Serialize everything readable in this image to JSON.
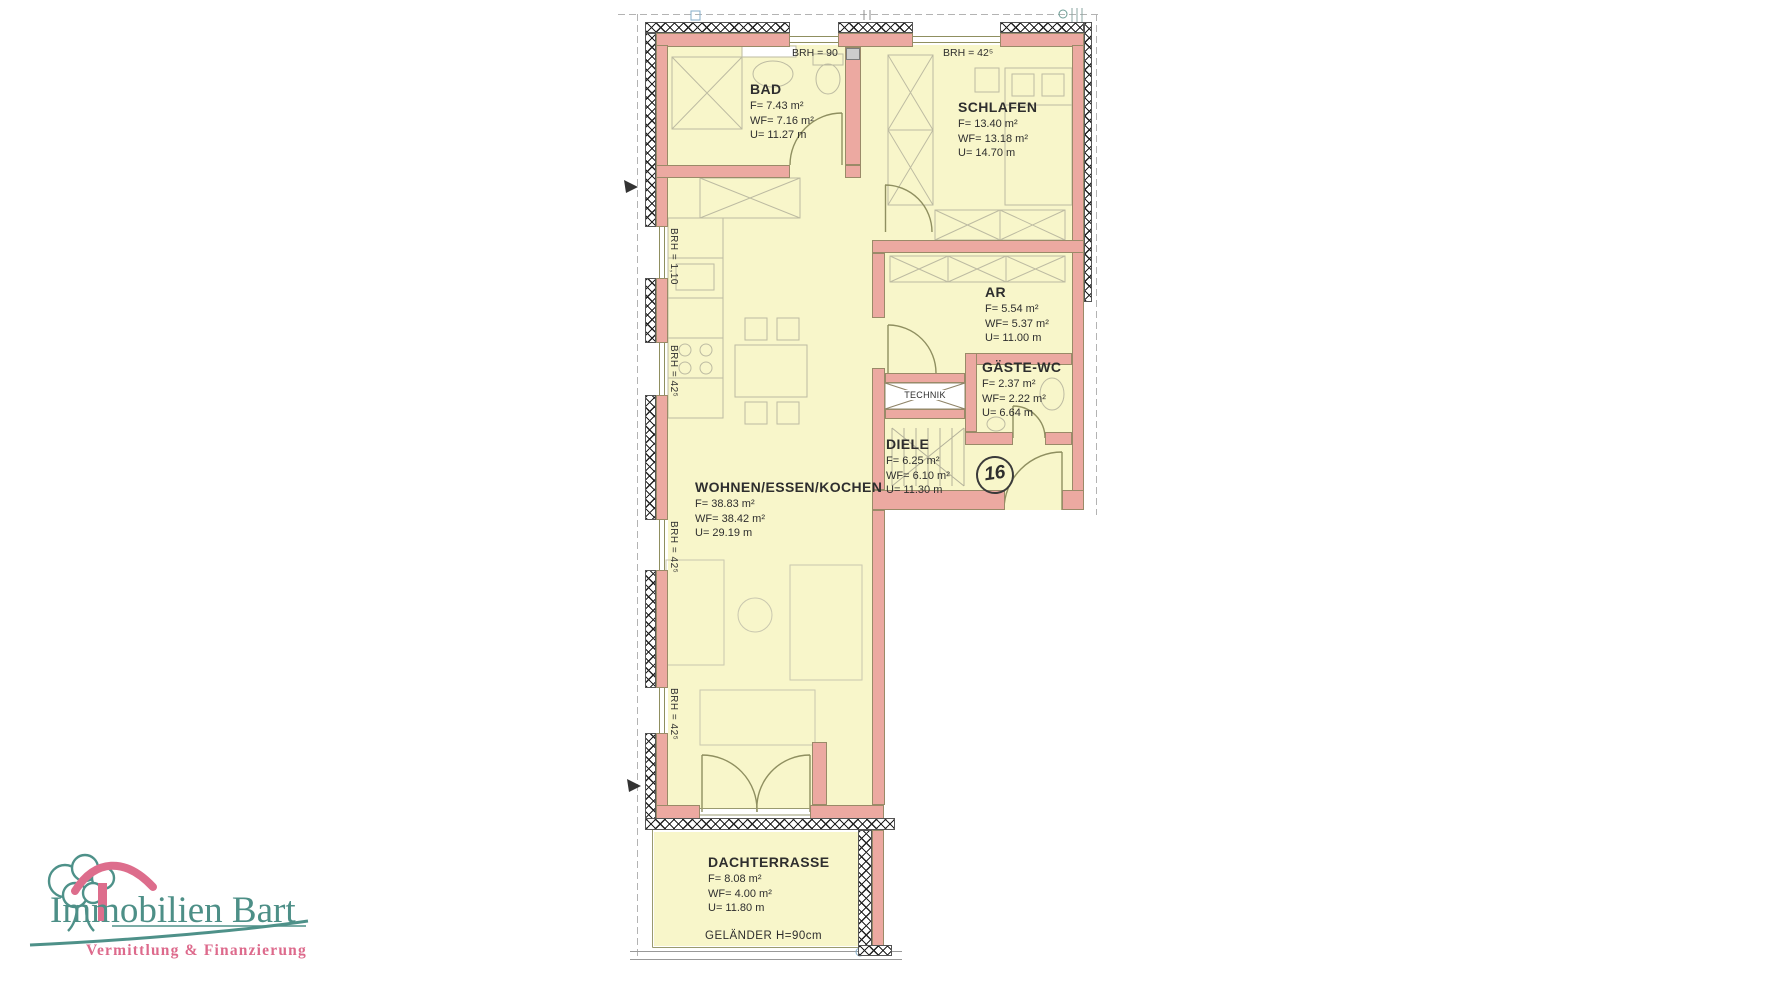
{
  "plan": {
    "rooms": {
      "bad": {
        "name": "BAD",
        "f": "F= 7.43 m²",
        "wf": "WF= 7.16 m²",
        "u": "U= 11.27 m"
      },
      "schlafen": {
        "name": "SCHLAFEN",
        "f": "F= 13.40 m²",
        "wf": "WF= 13.18 m²",
        "u": "U= 14.70 m"
      },
      "ar": {
        "name": "AR",
        "f": "F= 5.54 m²",
        "wf": "WF= 5.37 m²",
        "u": "U= 11.00 m"
      },
      "gaeste_wc": {
        "name": "GÄSTE-WC",
        "f": "F= 2.37 m²",
        "wf": "WF= 2.22 m²",
        "u": "U= 6.64 m"
      },
      "diele": {
        "name": "DIELE",
        "f": "F= 6.25 m²",
        "wf": "WF= 6.10 m²",
        "u": "U= 11.30 m"
      },
      "wohnen": {
        "name": "WOHNEN/ESSEN/KOCHEN",
        "f": "F= 38.83 m²",
        "wf": "WF= 38.42 m²",
        "u": "U= 29.19 m"
      },
      "dachterrasse": {
        "name": "DACHTERRASSE",
        "f": "F= 8.08 m²",
        "wf": "WF= 4.00 m²",
        "u": "U= 11.80 m"
      }
    },
    "annotations": {
      "technik": "TECHNIK",
      "gelaender": "GELÄNDER H=90cm",
      "unit_number": "16",
      "brh_top_bad": "BRH = 90",
      "brh_top_schlafen": "BRH = 42⁵",
      "brh_left_1": "BRH = 1,10",
      "brh_left_2": "BRH = 42⁵",
      "brh_left_3": "BRH = 42⁵",
      "brh_left_4": "BRH = 42⁵"
    },
    "colors": {
      "wall": "#eca9a1",
      "room_fill": "#f8f6ca",
      "linework": "#8f8f60"
    }
  },
  "logo": {
    "name": "Immobilien Bart",
    "tagline": "Vermittlung & Finanzierung",
    "teal": "#4d8f87",
    "pink": "#dd6a8c"
  }
}
